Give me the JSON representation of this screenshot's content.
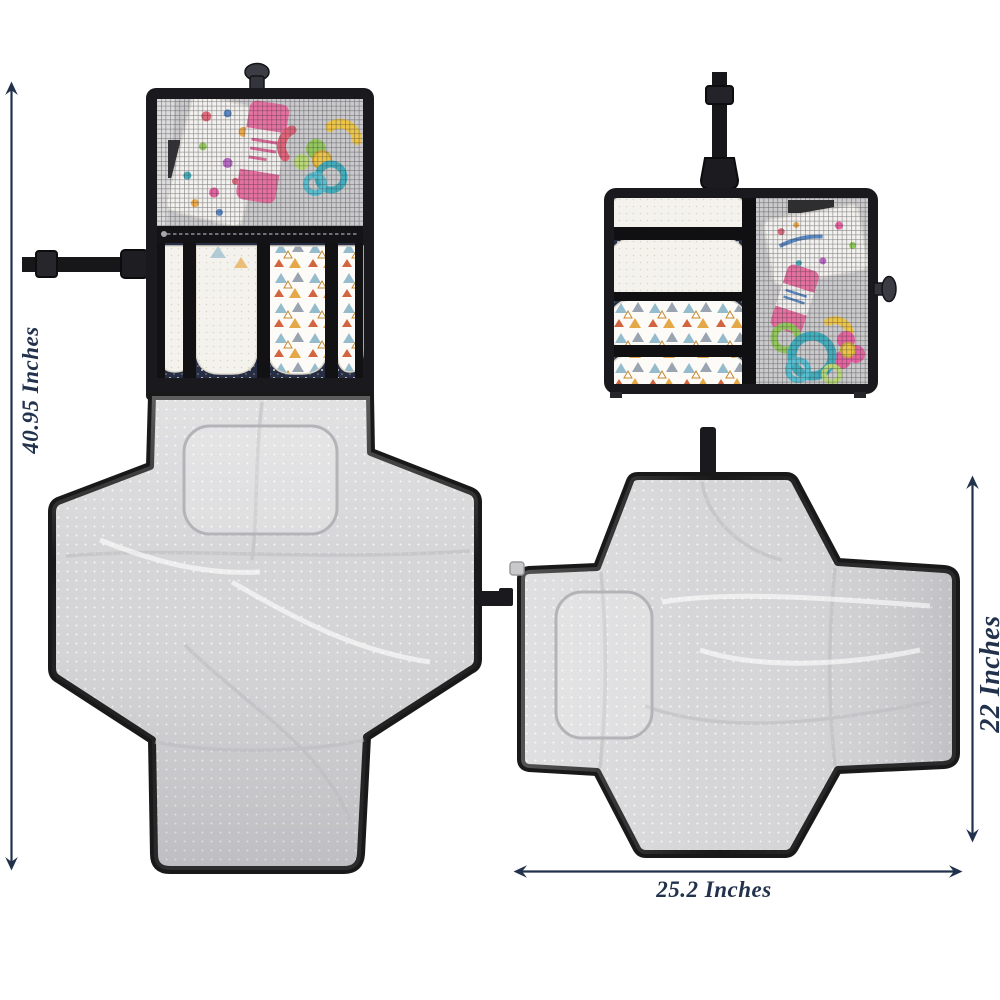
{
  "annotations": {
    "left_label": "40.95 Inches",
    "right_label": "22 Inches",
    "bottom_label": "25.2 Inches"
  },
  "palette": {
    "background": "#ffffff",
    "annotation": "#22324c",
    "fabric": "#1a1a1e",
    "mat": "#d5d5d7",
    "mat-edge": "#191919",
    "navy": "#272e44",
    "diaper": "#f4f2ec",
    "tube-pink": "#e8639a",
    "toy-teal": "#2fa9ba",
    "toy-green": "#8bc74c",
    "toy-yellow": "#f1c335",
    "toy-pink": "#e8559a",
    "print-blue": "#95bccd",
    "print-orange": "#e5a848"
  }
}
